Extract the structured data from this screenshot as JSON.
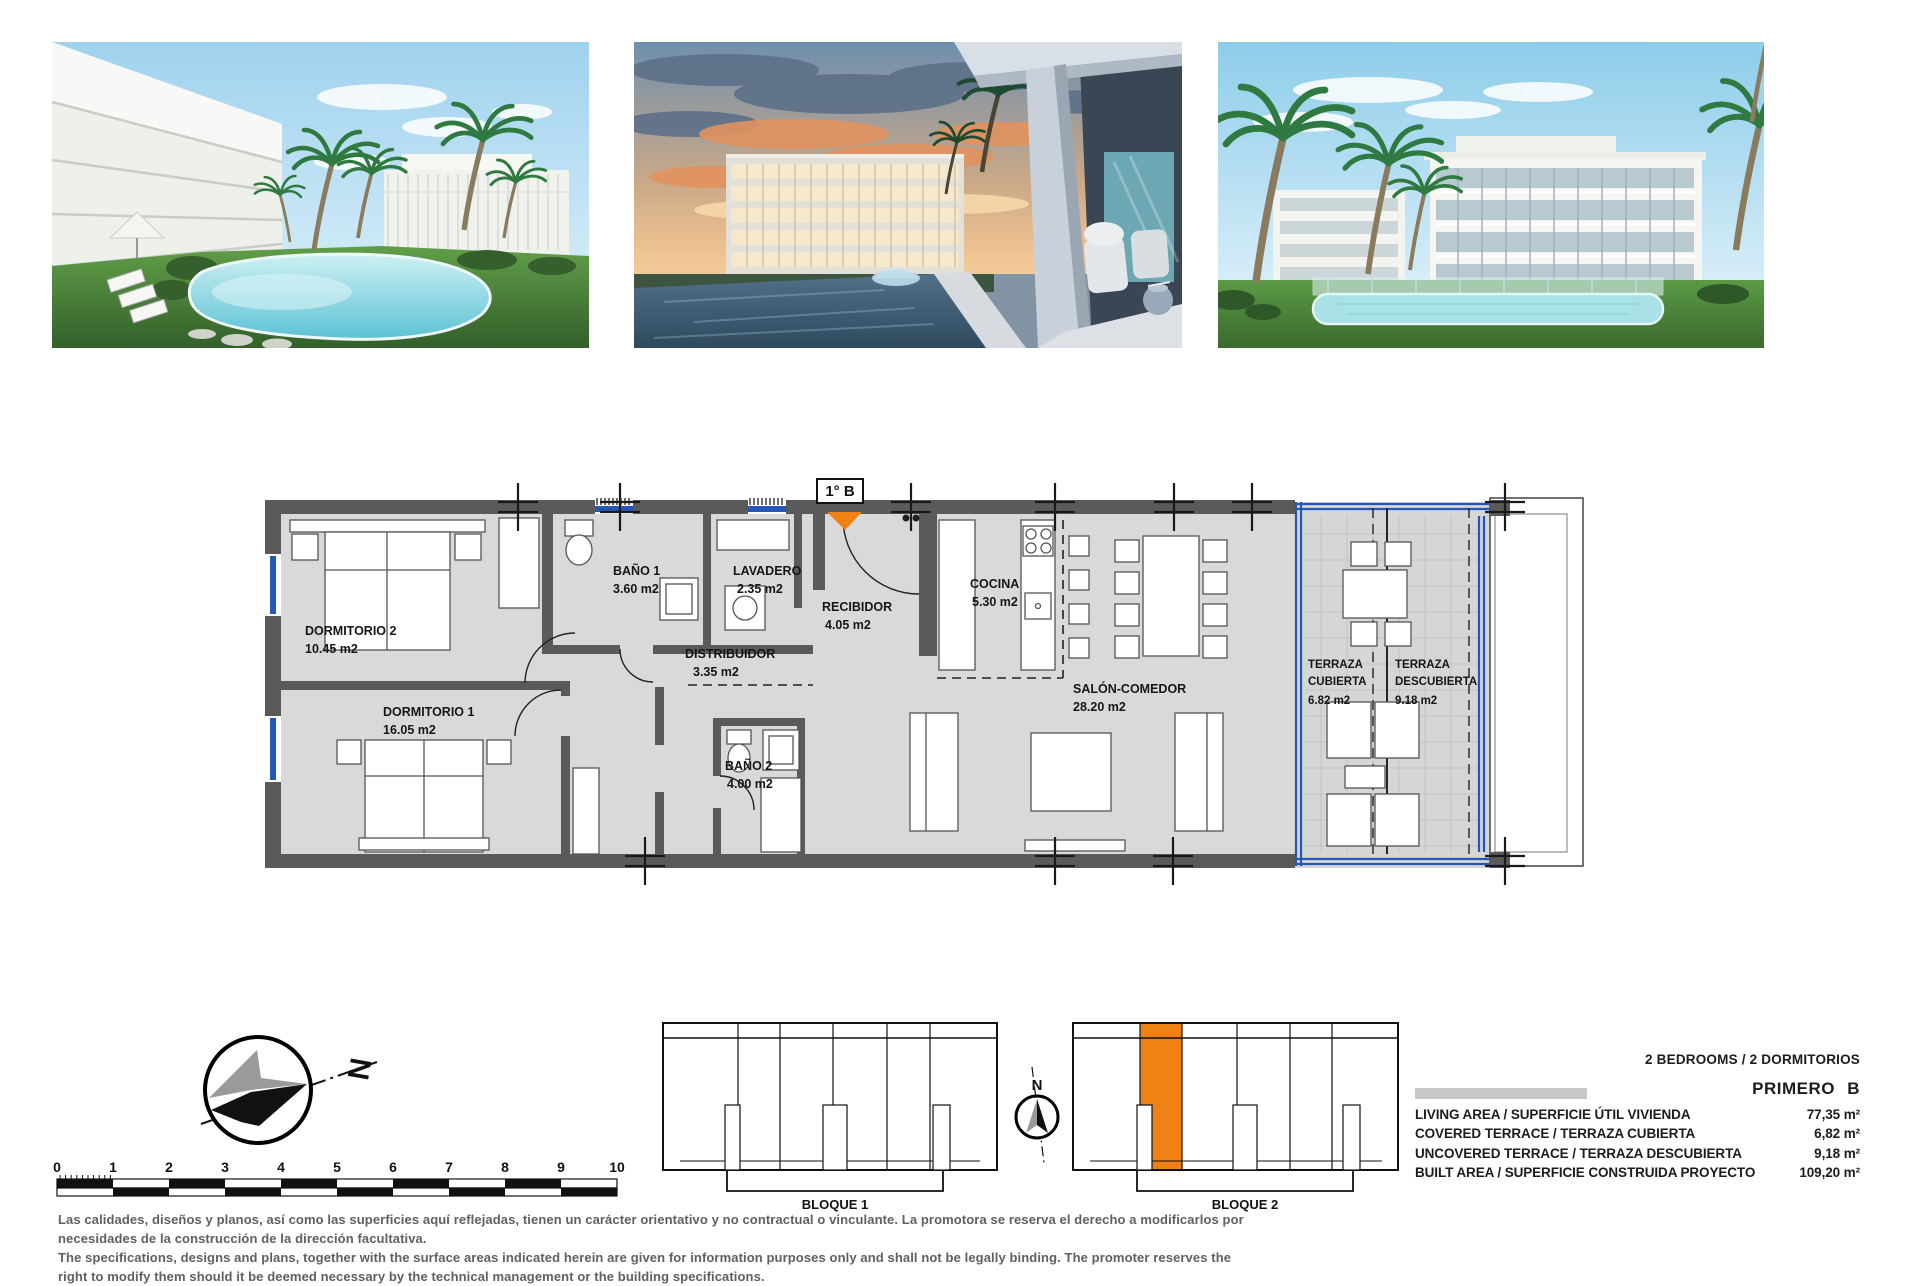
{
  "plan": {
    "unit_label": "1° B",
    "rooms": [
      {
        "name": "DORMITORIO 2",
        "area": "10.45 m2"
      },
      {
        "name": "DORMITORIO 1",
        "area": "16.05 m2"
      },
      {
        "name": "BAÑO 1",
        "area": "3.60 m2"
      },
      {
        "name": "LAVADERO",
        "area": "2.35 m2"
      },
      {
        "name": "RECIBIDOR",
        "area": "4.05 m2"
      },
      {
        "name": "DISTRIBUIDOR",
        "area": "3.35 m2"
      },
      {
        "name": "BAÑO 2",
        "area": "4.00 m2"
      },
      {
        "name": "COCINA",
        "area": "5.30 m2"
      },
      {
        "name": "SALÓN-COMEDOR",
        "area": "28.20 m2"
      },
      {
        "line1": "TERRAZA",
        "line2": "CUBIERTA",
        "area": "6.82 m2"
      },
      {
        "line1": "TERRAZA",
        "line2": "DESCUBIERTA",
        "area": "9.18 m2"
      }
    ]
  },
  "compass": {
    "north": "N"
  },
  "scale_bar": {
    "ticks": [
      "0",
      "1",
      "2",
      "3",
      "4",
      "5",
      "6",
      "7",
      "8",
      "9",
      "10"
    ]
  },
  "blocks": [
    {
      "label": "BLOQUE 1"
    },
    {
      "label": "BLOQUE 2"
    }
  ],
  "highlight_color": "#F08114",
  "specs": {
    "header": "2 BEDROOMS / 2 DORMITORIOS",
    "unit": "PRIMERO B",
    "rows": [
      {
        "label": "LIVING AREA / SUPERFICIE ÚTIL VIVIENDA",
        "value": "77,35 m²"
      },
      {
        "label": "COVERED TERRACE / TERRAZA CUBIERTA",
        "value": "6,82 m²"
      },
      {
        "label": "UNCOVERED TERRACE / TERRAZA DESCUBIERTA",
        "value": "9,18 m²"
      },
      {
        "label": "BUILT AREA / SUPERFICIE CONSTRUIDA PROYECTO",
        "value": "109,20 m²"
      }
    ]
  },
  "disclaimer": {
    "es_line1": "Las calidades, diseños y planos, así como las superficies aquí reflejadas, tienen un carácter orientativo y no contractual o vinculante. La promotora se reserva el derecho a modificarlos por",
    "es_line2": "necesidades de la construcción de la dirección facultativa.",
    "en_line1": "The specifications, designs and plans, together with the surface areas indicated herein are given for information purposes only and shall not be legally binding. The promoter reserves the",
    "en_line2": "right to modify them should it be deemed necessary by the technical management or the building specifications."
  }
}
